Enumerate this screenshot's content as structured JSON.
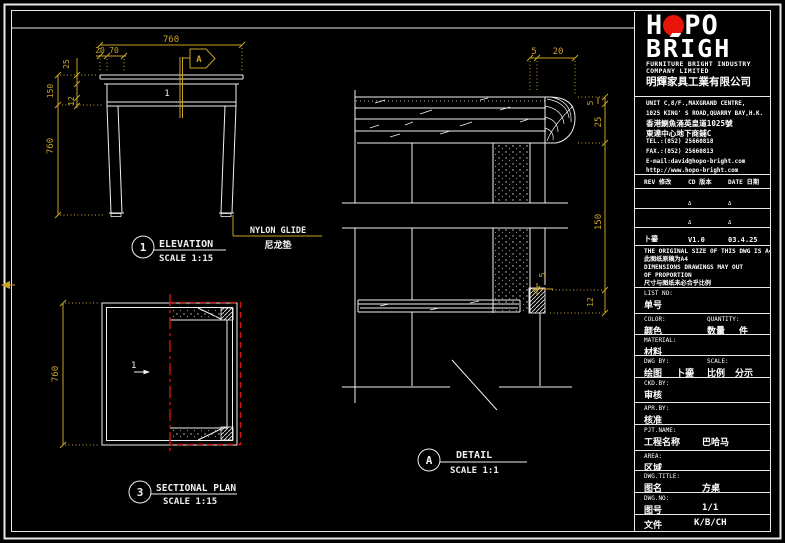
{
  "sheet": {
    "background": "#000000",
    "line_color": "#f0f0f0",
    "dim_color": "#c9a227",
    "section_color": "#cc1512",
    "logo_red": "#e81309"
  },
  "elevation": {
    "balloon": "1",
    "title": "ELEVATION",
    "scale": "SCALE 1:15",
    "part_label": "1",
    "section_marker": "A",
    "dim_width": "760",
    "dim_offset_20": "20",
    "dim_offset_70": "70",
    "dim_thickness_25": "25",
    "dim_apron_150": "150",
    "dim_edge_12": "12",
    "dim_height": "760",
    "callout_en": "NYLON GLIDE",
    "callout_cn": "尼龙垫"
  },
  "sectional_plan": {
    "balloon": "3",
    "title": "SECTIONAL PLAN",
    "scale": "SCALE 1:15",
    "part_label": "1",
    "dim_depth": "760"
  },
  "detail": {
    "balloon": "A",
    "title": "DETAIL",
    "scale": "SCALE 1:1",
    "dim_top_5": "5",
    "dim_top_20": "20",
    "dim_right_5": "5",
    "dim_right_25": "25",
    "dim_right_150": "150",
    "dim_glide_5": "5",
    "dim_right_12": "12"
  },
  "title_block": {
    "logo": {
      "h": "H",
      "po": "PO",
      "brigh": "BRIGH"
    },
    "company_en_line1": "FURNITURE BRIGHT INDUSTRY",
    "company_en_line2": "COMPANY LIMITED",
    "company_cn": "明輝家具工業有限公司",
    "address_lines": [
      "UNIT C,8/F.,MAXGRAND CENTRE,",
      "1025 KING' S ROAD,QUARRY BAY,H.K.",
      "香港鰂魚涌英皇道1025號",
      "東達中心地下商鋪C",
      "TEL.:(852) 25660818",
      "FAX.:(852) 25660813",
      "E-mail:david@hopo-bright.com",
      "http://www.hopo-bright.com"
    ],
    "rev_header": {
      "rev": "REV 修改",
      "cd": "CD 版本",
      "date": "DATE 日期"
    },
    "rev_rows": [
      {
        "rev": "",
        "cd": "Δ",
        "date": "Δ"
      },
      {
        "rev": "",
        "cd": "Δ",
        "date": "Δ"
      },
      {
        "rev": "卜鎏",
        "cd": "V1.0",
        "date": "03.4.25"
      }
    ],
    "notes": [
      "THE ORIGINAL SIZE OF THIS DWG IS A4",
      "此图纸原稿为A4",
      "DIMENSIONS DRAWINGS MAY OUT",
      "OF PROPORTION",
      "尺寸与图纸未必合乎比例"
    ],
    "fields": {
      "list_no": {
        "en": "LIST NO:",
        "cn": "单号",
        "value": ""
      },
      "color": {
        "en": "COLOR:",
        "cn": "颜色",
        "value": ""
      },
      "quantity": {
        "en": "QUANTITY:",
        "cn": "数量",
        "unit": "件",
        "value": ""
      },
      "material": {
        "en": "MATERIAL:",
        "cn": "材料",
        "value": ""
      },
      "dwg_by": {
        "en": "DWG  BY:",
        "cn": "绘图",
        "value": "卜鎏"
      },
      "scale": {
        "en": "SCALE:",
        "cn": "比例",
        "value": "分示"
      },
      "ckd_by": {
        "en": "CKD.BY:",
        "cn": "审核",
        "value": ""
      },
      "apr_by": {
        "en": "APR.BY:",
        "cn": "核准",
        "value": ""
      },
      "pjt_name": {
        "en": "PJT.NAME:",
        "cn": "工程名称",
        "value": "巴哈马"
      },
      "area": {
        "en": "AREA:",
        "cn": "区域",
        "value": ""
      },
      "dwg_title": {
        "en": "DWG.TITLE:",
        "cn": "图名",
        "value": "方桌"
      },
      "dwg_no": {
        "en": "DWG.NO:",
        "cn": "图号",
        "value": "1/1"
      },
      "file": {
        "en": "FILE:",
        "cn": "文件",
        "value": "K/B/CH"
      }
    }
  }
}
